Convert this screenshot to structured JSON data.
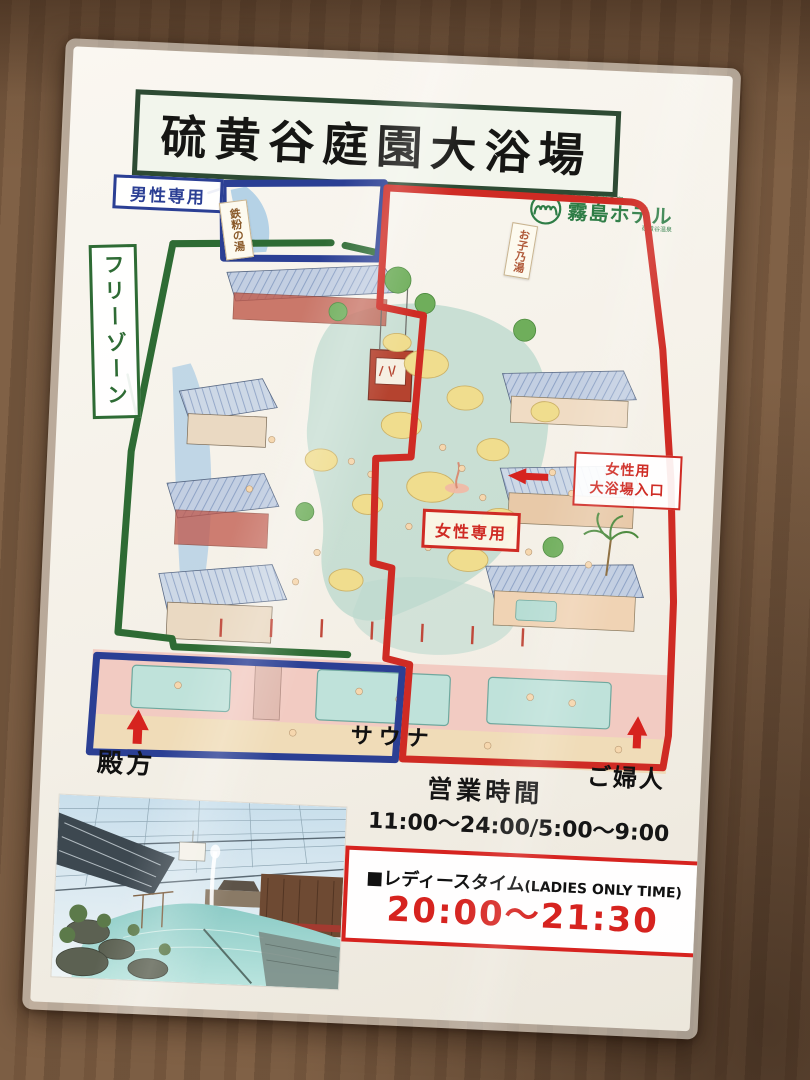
{
  "title": "硫黄谷庭園大浴場",
  "logo": {
    "tagline_top": "庭園と名湯の宿",
    "hotel_name": "霧島ホテル",
    "tagline_bottom": "硫黄谷温泉"
  },
  "zones": {
    "men_only": "男性専用",
    "free_zone": "フリーゾーン",
    "women_only": "女性専用",
    "women_entrance_line1": "女性用",
    "women_entrance_line2": "大浴場入口"
  },
  "map_labels": {
    "bath_sign_left": "鉄粉の湯",
    "bath_sign_right": "お子乃湯",
    "exit_men": "殿方",
    "sauna": "サウナ",
    "exit_women": "ご婦人"
  },
  "hours": {
    "heading": "営業時間",
    "time_range": "11:00～24:00/5:00～9:00",
    "ladies_label": "■レディースタイム",
    "ladies_en": "(LADIES ONLY TIME)",
    "ladies_time": "20:00～21:30"
  },
  "colors": {
    "zone_men_blue": "#2b3f94",
    "zone_free_green": "#2e6b34",
    "zone_women_red": "#cf2b24",
    "brand_green": "#2e7d46"
  }
}
